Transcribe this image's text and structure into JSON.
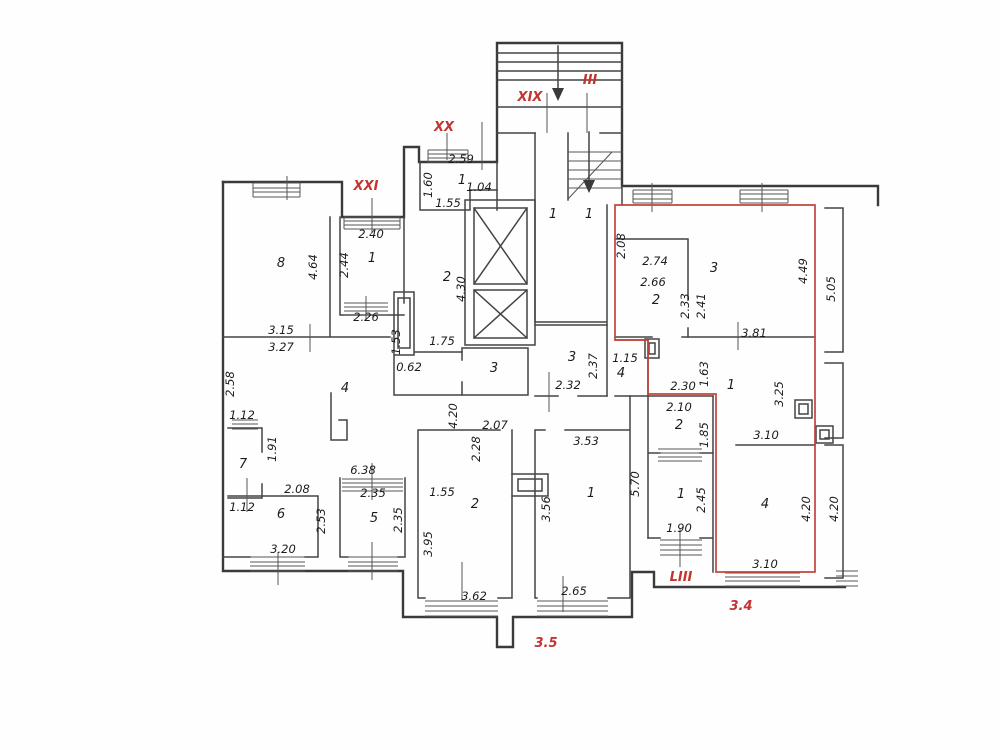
{
  "drawing": {
    "type": "architectural-floor-plan",
    "background_color": "#ffffff",
    "wall_color": "#3a3a3a",
    "highlight_color": "#c4453c",
    "red_annotations": [
      {
        "text": "XXI",
        "x": 366,
        "y": 190,
        "rot": 0
      },
      {
        "text": "XX",
        "x": 444,
        "y": 131,
        "rot": 0
      },
      {
        "text": "XIX",
        "x": 530,
        "y": 101,
        "rot": 0
      },
      {
        "text": "III",
        "x": 590,
        "y": 84,
        "rot": 0
      },
      {
        "text": "LIII",
        "x": 681,
        "y": 581,
        "rot": 0
      },
      {
        "text": "3.4",
        "x": 741,
        "y": 610,
        "rot": 0
      },
      {
        "text": "3.5",
        "x": 546,
        "y": 647,
        "rot": 0
      }
    ],
    "room_labels": [
      {
        "text": "8",
        "x": 281,
        "y": 267
      },
      {
        "text": "1",
        "x": 372,
        "y": 262
      },
      {
        "text": "2",
        "x": 447,
        "y": 281
      },
      {
        "text": "1",
        "x": 462,
        "y": 184
      },
      {
        "text": "1",
        "x": 553,
        "y": 218
      },
      {
        "text": "1",
        "x": 589,
        "y": 218
      },
      {
        "text": "3",
        "x": 494,
        "y": 372
      },
      {
        "text": "3",
        "x": 572,
        "y": 361
      },
      {
        "text": "4",
        "x": 345,
        "y": 392
      },
      {
        "text": "7",
        "x": 243,
        "y": 468
      },
      {
        "text": "6",
        "x": 281,
        "y": 518
      },
      {
        "text": "5",
        "x": 374,
        "y": 522
      },
      {
        "text": "2",
        "x": 475,
        "y": 508
      },
      {
        "text": "1",
        "x": 591,
        "y": 497
      },
      {
        "text": "3",
        "x": 714,
        "y": 272
      },
      {
        "text": "2",
        "x": 656,
        "y": 304
      },
      {
        "text": "1",
        "x": 731,
        "y": 389
      },
      {
        "text": "2",
        "x": 679,
        "y": 429
      },
      {
        "text": "1",
        "x": 681,
        "y": 498
      },
      {
        "text": "4",
        "x": 765,
        "y": 508
      },
      {
        "text": "4",
        "x": 621,
        "y": 377
      }
    ],
    "dimensions": [
      {
        "text": "2.59",
        "x": 461,
        "y": 163,
        "rot": 0
      },
      {
        "text": "1.04",
        "x": 479,
        "y": 191,
        "rot": 0
      },
      {
        "text": "1.55",
        "x": 448,
        "y": 207,
        "rot": 0
      },
      {
        "text": "2.40",
        "x": 371,
        "y": 238,
        "rot": 0
      },
      {
        "text": "2.26",
        "x": 366,
        "y": 321,
        "rot": 0
      },
      {
        "text": "3.15",
        "x": 281,
        "y": 334,
        "rot": 0
      },
      {
        "text": "3.27",
        "x": 281,
        "y": 351,
        "rot": 0
      },
      {
        "text": "1.75",
        "x": 442,
        "y": 345,
        "rot": 0
      },
      {
        "text": "0.62",
        "x": 409,
        "y": 371,
        "rot": 0
      },
      {
        "text": "2.74",
        "x": 655,
        "y": 265,
        "rot": 0
      },
      {
        "text": "2.66",
        "x": 653,
        "y": 286,
        "rot": 0
      },
      {
        "text": "3.81",
        "x": 754,
        "y": 337,
        "rot": 0
      },
      {
        "text": "2.30",
        "x": 683,
        "y": 390,
        "rot": 0
      },
      {
        "text": "2.10",
        "x": 679,
        "y": 411,
        "rot": 0
      },
      {
        "text": "3.10",
        "x": 766,
        "y": 439,
        "rot": 0
      },
      {
        "text": "1.90",
        "x": 679,
        "y": 532,
        "rot": 0
      },
      {
        "text": "3.10",
        "x": 765,
        "y": 568,
        "rot": 0
      },
      {
        "text": "2.07",
        "x": 495,
        "y": 429,
        "rot": 0
      },
      {
        "text": "2.32",
        "x": 568,
        "y": 389,
        "rot": 0
      },
      {
        "text": "3.53",
        "x": 586,
        "y": 445,
        "rot": 0
      },
      {
        "text": "2.65",
        "x": 574,
        "y": 595,
        "rot": 0
      },
      {
        "text": "3.62",
        "x": 474,
        "y": 600,
        "rot": 0
      },
      {
        "text": "1.55",
        "x": 442,
        "y": 496,
        "rot": 0
      },
      {
        "text": "6.38",
        "x": 363,
        "y": 474,
        "rot": 0
      },
      {
        "text": "2.08",
        "x": 297,
        "y": 493,
        "rot": 0
      },
      {
        "text": "2.35",
        "x": 373,
        "y": 497,
        "rot": 0
      },
      {
        "text": "1.12",
        "x": 242,
        "y": 419,
        "rot": 0
      },
      {
        "text": "1.12",
        "x": 242,
        "y": 511,
        "rot": 0
      },
      {
        "text": "3.20",
        "x": 283,
        "y": 553,
        "rot": 0
      },
      {
        "text": "1.15",
        "x": 625,
        "y": 362,
        "rot": 0
      },
      {
        "text": "1.60",
        "x": 432,
        "y": 185,
        "rot": -90
      },
      {
        "text": "2.44",
        "x": 348,
        "y": 265,
        "rot": -90
      },
      {
        "text": "4.64",
        "x": 317,
        "y": 267,
        "rot": -90
      },
      {
        "text": "2.58",
        "x": 234,
        "y": 384,
        "rot": -90
      },
      {
        "text": "1.53",
        "x": 400,
        "y": 342,
        "rot": -90
      },
      {
        "text": "4.30",
        "x": 465,
        "y": 289,
        "rot": -90
      },
      {
        "text": "2.08",
        "x": 625,
        "y": 246,
        "rot": -90
      },
      {
        "text": "2.33",
        "x": 689,
        "y": 306,
        "rot": -90
      },
      {
        "text": "2.41",
        "x": 705,
        "y": 306,
        "rot": -90
      },
      {
        "text": "4.49",
        "x": 807,
        "y": 271,
        "rot": -90
      },
      {
        "text": "5.05",
        "x": 835,
        "y": 289,
        "rot": -90
      },
      {
        "text": "1.63",
        "x": 708,
        "y": 374,
        "rot": -90
      },
      {
        "text": "3.25",
        "x": 783,
        "y": 394,
        "rot": -90
      },
      {
        "text": "1.85",
        "x": 708,
        "y": 435,
        "rot": -90
      },
      {
        "text": "2.45",
        "x": 705,
        "y": 500,
        "rot": -90
      },
      {
        "text": "5.70",
        "x": 639,
        "y": 484,
        "rot": -90
      },
      {
        "text": "4.20",
        "x": 810,
        "y": 509,
        "rot": -90
      },
      {
        "text": "4.20",
        "x": 838,
        "y": 509,
        "rot": -90
      },
      {
        "text": "2.37",
        "x": 597,
        "y": 366,
        "rot": -90
      },
      {
        "text": "3.56",
        "x": 550,
        "y": 509,
        "rot": -90
      },
      {
        "text": "3.95",
        "x": 432,
        "y": 544,
        "rot": -90
      },
      {
        "text": "2.28",
        "x": 480,
        "y": 449,
        "rot": -90
      },
      {
        "text": "2.53",
        "x": 325,
        "y": 521,
        "rot": -90
      },
      {
        "text": "2.35",
        "x": 402,
        "y": 520,
        "rot": -90
      },
      {
        "text": "1.91",
        "x": 276,
        "y": 449,
        "rot": -90
      },
      {
        "text": "4.20",
        "x": 457,
        "y": 416,
        "rot": -90
      }
    ]
  }
}
